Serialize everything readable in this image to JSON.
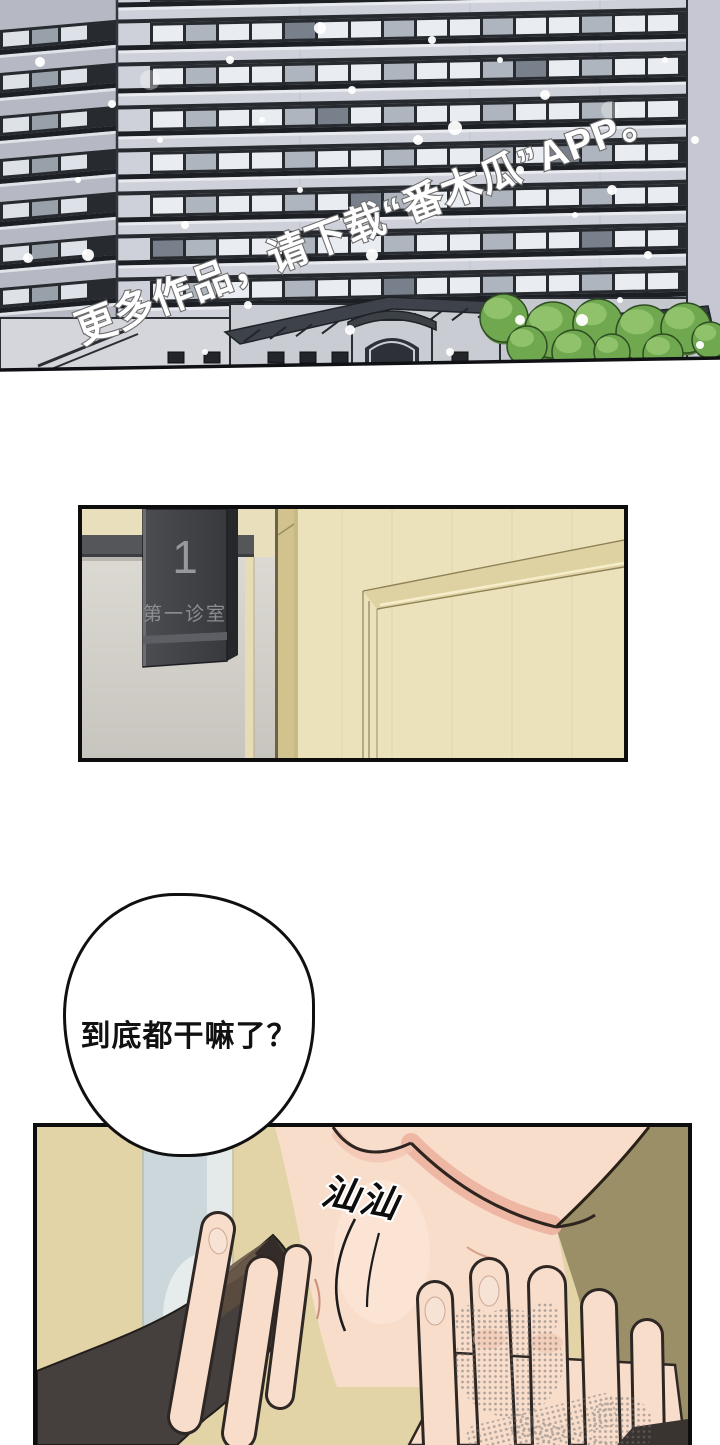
{
  "page": {
    "background": "#ffffff",
    "width": 720,
    "height": 1440
  },
  "panel_building": {
    "description": "hospital exterior in snowfall",
    "watermark_text": "更多作品，请下载“番木瓜”APP。",
    "colors": {
      "sky": "#c6c7d3",
      "facade_light": "#ced1d9",
      "facade_shadow": "#b6b9c3",
      "window_frame": "#272a2f",
      "pane_light": "#e9edf2",
      "pane_mid": "#aeb5be",
      "roof_dark": "#3e434b",
      "tree_mid": "#6fa84e",
      "tree_dark": "#507d36",
      "tree_light": "#94c470",
      "snow": "#ffffff"
    }
  },
  "panel_door": {
    "description": "clinic door with hanging room sign",
    "sign_number": "1",
    "sign_label": "第一诊室",
    "colors": {
      "sign_plate": "#404145",
      "sign_text": "#96989c",
      "wall_gray": "#d5d2cc",
      "wall_cream": "#e9dfbc",
      "door_wood": "#ebe1ba",
      "jamb": "#d2c28d",
      "beam": "#55565a"
    }
  },
  "speech_bubble": {
    "text": "到底都干嘛了？"
  },
  "panel_closeup": {
    "description": "hand touching neck close-up",
    "sfx_text": "汕汕",
    "colors": {
      "wall_beige": "#e2d4a6",
      "wall_olive": "#9a8f66",
      "window_blue": "#ccd7db",
      "skin": "#f8ddcb",
      "skin_shadow": "#edb4a1",
      "clothing_dark": "#45403d",
      "collar_brown": "#6a5a49",
      "halftone_gray": "#6f6f6f"
    }
  }
}
